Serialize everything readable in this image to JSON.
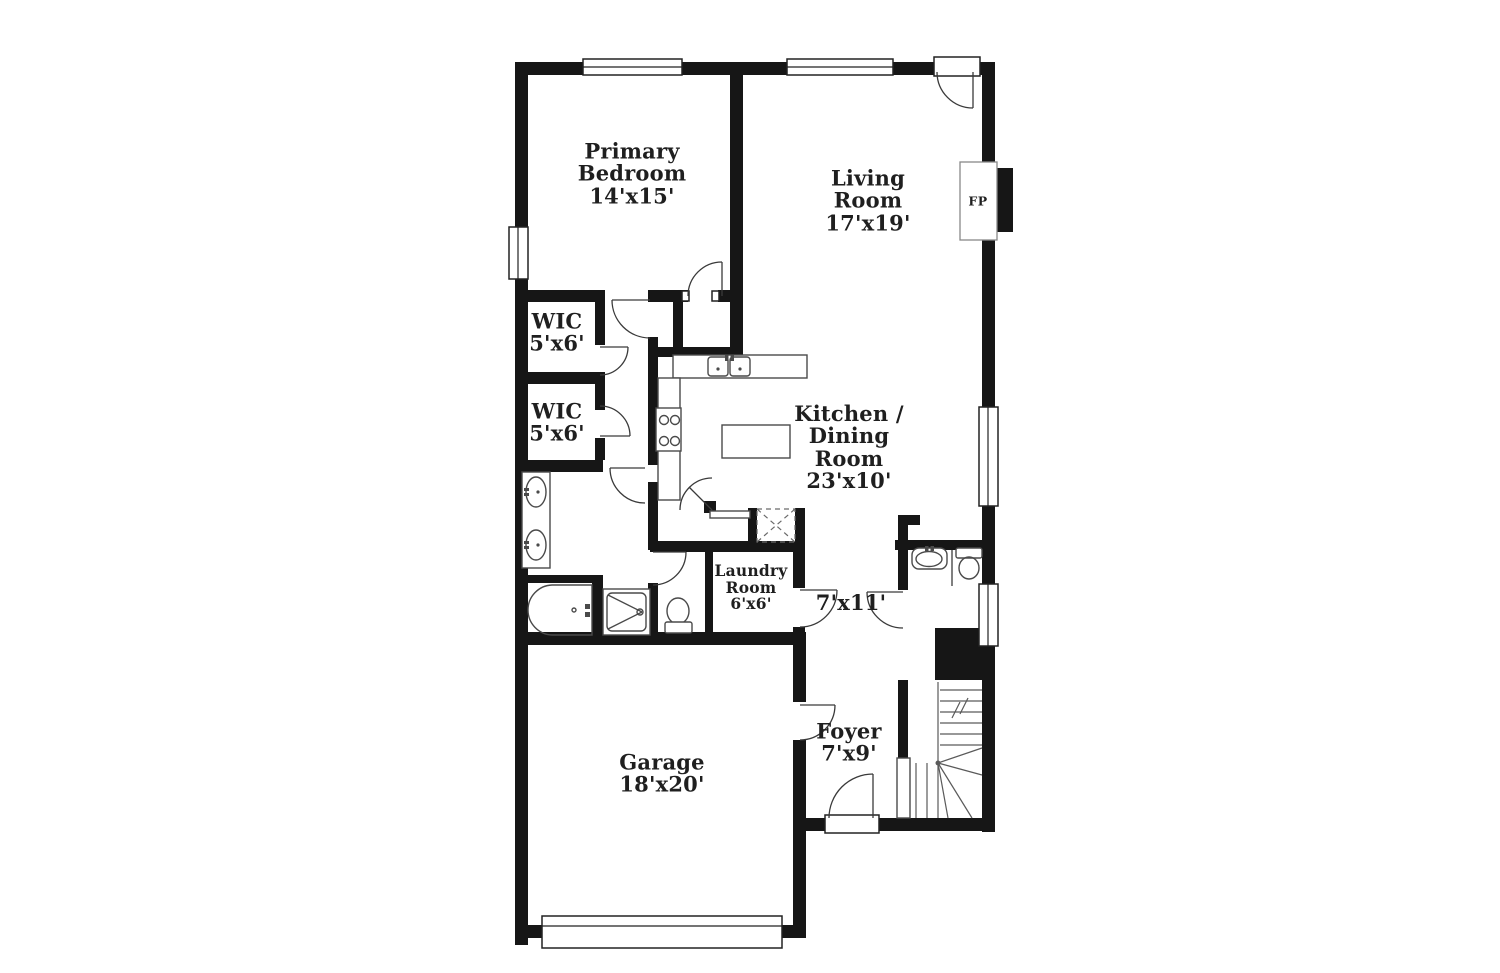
{
  "palette": {
    "background": "#ffffff",
    "wall": "#161616",
    "thin_line": "#4a4a4a",
    "text": "#1f1f1f"
  },
  "rooms": [
    {
      "id": "primary-bedroom",
      "name": "Primary Bedroom",
      "dims": "14'x15'"
    },
    {
      "id": "living-room",
      "name": "Living Room",
      "dims": "17'x19'"
    },
    {
      "id": "wic-upper",
      "name": "WIC",
      "dims": "5'x6'"
    },
    {
      "id": "wic-lower",
      "name": "WIC",
      "dims": "5'x6'"
    },
    {
      "id": "kitchen-dining",
      "name": "Kitchen / Dining Room",
      "dims": "23'x10'"
    },
    {
      "id": "laundry-room",
      "name": "Laundry Room",
      "dims": "6'x6'"
    },
    {
      "id": "hallway",
      "name": "",
      "dims": "7'x11'"
    },
    {
      "id": "foyer",
      "name": "Foyer",
      "dims": "7'x9'"
    },
    {
      "id": "garage",
      "name": "Garage",
      "dims": "18'x20'"
    }
  ],
  "annotations": {
    "fireplace_label": "FP"
  }
}
